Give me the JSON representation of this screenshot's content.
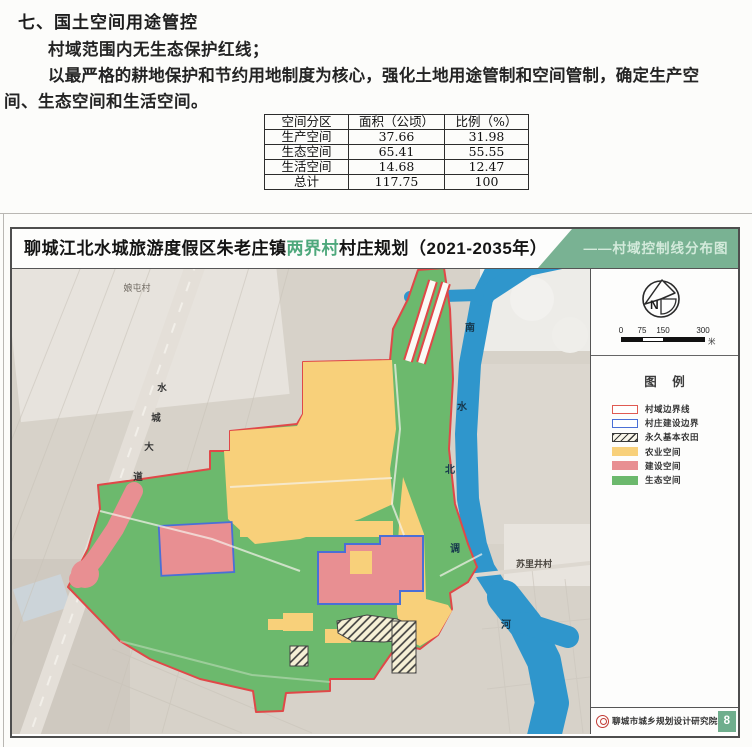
{
  "doc": {
    "heading": "七、国土空间用途管控",
    "line1": "村域范围内无生态保护红线；",
    "line2": "以最严格的耕地保护和节约用地制度为核心，强化土地用途管制和空间管制，确定生产空",
    "line3": "间、生态空间和生活空间。",
    "table": {
      "headers": [
        "空间分区",
        "面积（公顷）",
        "比例（%）"
      ],
      "rows": [
        [
          "生产空间",
          "37.66",
          "31.98"
        ],
        [
          "生态空间",
          "65.41",
          "55.55"
        ],
        [
          "生活空间",
          "14.68",
          "12.47"
        ],
        [
          "总计",
          "117.75",
          "100"
        ]
      ]
    }
  },
  "panel": {
    "title": {
      "part1": "聊城江北水城旅游度假区朱老庄镇",
      "highlight": "两界村",
      "part2": "村庄规划（2021-2035年）",
      "right": "——村域控制线分布图"
    },
    "map": {
      "village_nw": "娘屯村",
      "village_e": "苏里井村",
      "road_chars": [
        "水",
        "城",
        "大",
        "道"
      ],
      "river_chars": [
        "南",
        "水",
        "北",
        "调",
        "河"
      ]
    },
    "sidebar": {
      "compass_n": "N",
      "scale_ticks": [
        "0",
        "75",
        "150",
        "300"
      ],
      "scale_unit": "米",
      "legend_title": "图 例",
      "legend": [
        {
          "label": "村域边界线"
        },
        {
          "label": "村庄建设边界"
        },
        {
          "label": "永久基本农田"
        },
        {
          "label": "农业空间"
        },
        {
          "label": "建设空间"
        },
        {
          "label": "生态空间"
        }
      ],
      "footer_org": "聊城市城乡规划设计研究院",
      "footer_page": "8"
    },
    "colors": {
      "agriculture": "#f8d07a",
      "construction": "#e88f92",
      "ecology": "#6cb96d",
      "river": "#2f96cc",
      "boundary_red": "#e04848",
      "boundary_blue": "#4a6fd6",
      "header_green": "#79b293"
    }
  }
}
